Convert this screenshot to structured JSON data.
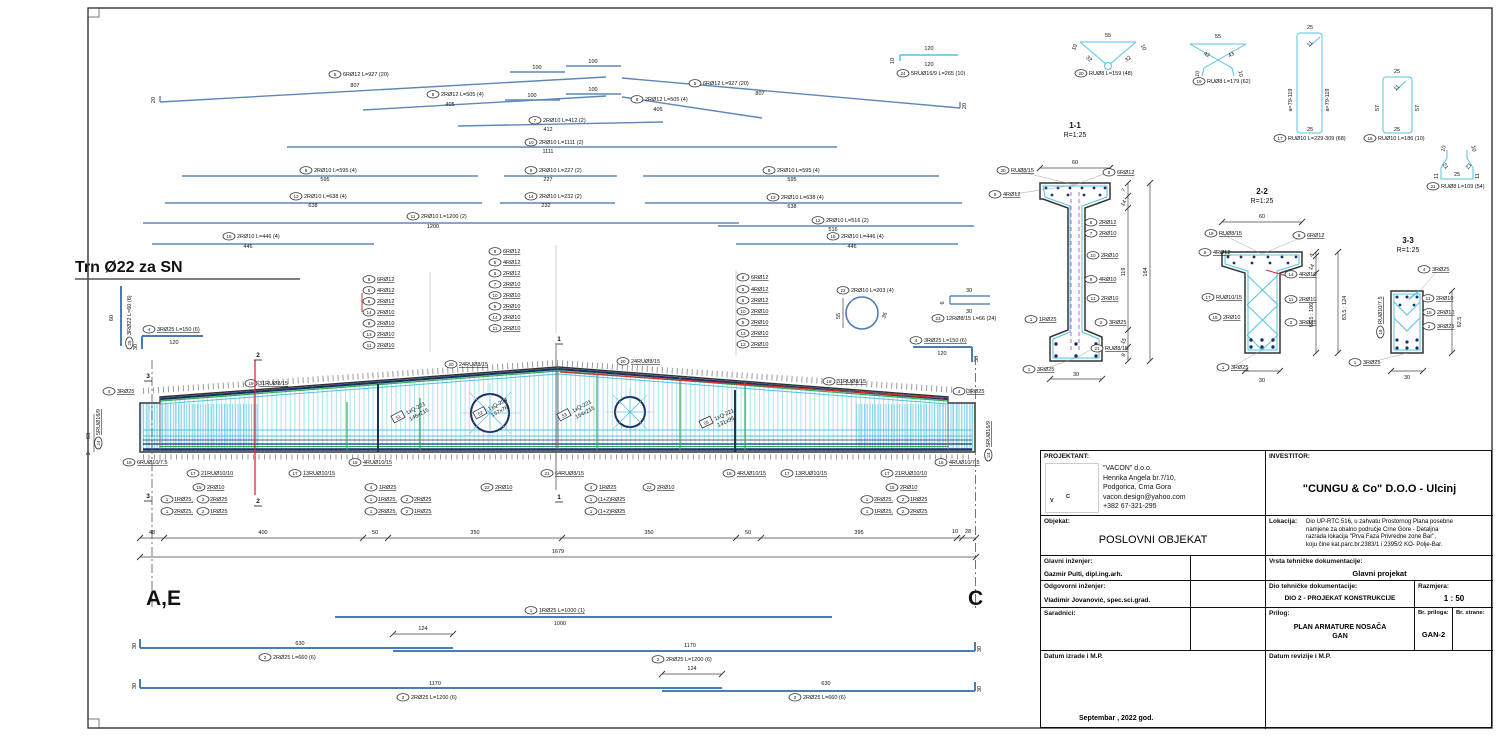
{
  "headings": {
    "trn": "Trn Ø22 za SN",
    "grid_left": "A,E",
    "grid_right": "C"
  },
  "bars": [
    {
      "mark": "5",
      "text": "6RØ12 L=927 (20)",
      "len": "807"
    },
    {
      "mark": "5",
      "text": "6RØ12 L=927 (20)",
      "len": "807"
    },
    {
      "mark": "8",
      "text": "2RØ12 L=505 (4)",
      "len": "405"
    },
    {
      "mark": "8",
      "text": "2RØ12 L=505 (4)",
      "len": "405"
    },
    {
      "mark": "7",
      "text": "2RØ10 L=412 (2)",
      "len": "412"
    },
    {
      "mark": "10",
      "text": "2RØ10 L=1111 (2)",
      "len": "1111"
    },
    {
      "mark": "9",
      "text": "2RØ10 L=595 (4)",
      "len": "595"
    },
    {
      "mark": "9",
      "text": "2RØ10 L=227 (2)",
      "len": "227"
    },
    {
      "mark": "9",
      "text": "2RØ10 L=595 (4)",
      "len": "595"
    },
    {
      "mark": "13",
      "text": "2RØ10 L=638 (4)",
      "len": "638"
    },
    {
      "mark": "14",
      "text": "2RØ10 L=232 (2)",
      "len": "232"
    },
    {
      "mark": "13",
      "text": "2RØ10 L=638 (4)",
      "len": "638"
    },
    {
      "mark": "11",
      "text": "2RØ10 L=1200 (2)",
      "len": "1200"
    },
    {
      "mark": "12",
      "text": "2RØ10 L=516 (2)",
      "len": "516"
    },
    {
      "mark": "15",
      "text": "2RØ10 L=446 (4)",
      "len": "446"
    },
    {
      "mark": "15",
      "text": "2RØ10 L=446 (4)",
      "len": "446"
    }
  ],
  "bar_dims": {
    "hook": "20",
    "d100": "100"
  },
  "details": {
    "d24": {
      "mark": "24",
      "text": "5RUØ16/9 L=265 (10)",
      "dim1": "120",
      "dim2": "120",
      "dim3": "10"
    },
    "d20": {
      "mark": "20",
      "text": "RUØ8 L=159 (48)",
      "w": "55",
      "s1": "10",
      "s2": "10",
      "b1": "32",
      "b2": "32"
    },
    "d19": {
      "mark": "19",
      "text": "RUØ8 L=179 (62)",
      "w": "55",
      "a1": "42",
      "a2": "43",
      "l1": "10",
      "l2": "10"
    },
    "d17": {
      "mark": "17",
      "text": "RUØ10 L=229-309 (68)",
      "top": "25",
      "diag": "11",
      "side": "a=79-119",
      "bottom": "25"
    },
    "d16": {
      "mark": "16",
      "text": "RUØ10 L=186 (10)",
      "top": "25",
      "diag": "11",
      "side": "57",
      "bottom": "25"
    },
    "d21": {
      "mark": "21",
      "text": "RUØ8 L=109 (54)",
      "t1": "10",
      "t2": "10",
      "m1": "21",
      "m2": "21",
      "s1": "11",
      "s2": "11",
      "b": "25"
    },
    "d22": {
      "mark": "22",
      "text": "2RØ10 L=203 (4)",
      "d1": "55",
      "d2": "36"
    },
    "d23": {
      "mark": "23",
      "text": "12RØ8/15 L=66 (24)",
      "d1": "30",
      "d2": "30",
      "d3": "6"
    },
    "d4l": {
      "mark": "4",
      "text": "3RØ25 L=150 (6)",
      "len": "120",
      "hook": "30"
    },
    "d4r": {
      "mark": "4",
      "text": "3RØ25 L=150 (6)",
      "len": "120",
      "hook": "30"
    },
    "d25": {
      "mark": "25",
      "text": "3RØ22 L=60 (6)",
      "len": "60"
    }
  },
  "s11": {
    "title": "1-1",
    "scale": "R=1:25",
    "top": "60",
    "bottom": "30",
    "d7": "7",
    "d14": "14",
    "d119": "119",
    "d164": "164",
    "d15": "15",
    "d9": "9",
    "l20": {
      "mark": "20",
      "text": "RUØ8/15"
    },
    "l5": {
      "mark": "5",
      "text": "4RØ12"
    },
    "l8": {
      "mark": "8",
      "text": "6RØ12"
    },
    "l6": {
      "mark": "6",
      "text": "2RØ12"
    },
    "l7": {
      "mark": "7",
      "text": "2RØ10"
    },
    "l10": {
      "mark": "10",
      "text": "2RØ10"
    },
    "l9": {
      "mark": "9",
      "text": "4RØ10"
    },
    "l11": {
      "mark": "11",
      "text": "2RØ10"
    },
    "l1a": {
      "mark": "1",
      "text": "1RØ25"
    },
    "l2": {
      "mark": "2",
      "text": "3RØ25"
    },
    "l21": {
      "mark": "21",
      "text": "RUØ8/15"
    },
    "l1b": {
      "mark": "1",
      "text": "3RØ25"
    }
  },
  "s22": {
    "title": "2-2",
    "scale": "R=1:25",
    "top": "60",
    "bottom": "30",
    "d4": "4",
    "d14": "14",
    "dmid": "65.5 : 106",
    "douter": "83.5 : 124",
    "l19": {
      "mark": "19",
      "text": "RUØ8/15"
    },
    "l5": {
      "mark": "5",
      "text": "4RØ12"
    },
    "l8": {
      "mark": "8",
      "text": "6RØ12"
    },
    "l14": {
      "mark": "14",
      "text": "4RØ10"
    },
    "l17": {
      "mark": "17",
      "text": "RUØ10/15"
    },
    "l11": {
      "mark": "11",
      "text": "2RØ10"
    },
    "l15": {
      "mark": "15",
      "text": "2RØ10"
    },
    "l2": {
      "mark": "2",
      "text": "3RØ25"
    },
    "l1": {
      "mark": "1",
      "text": "3RØ25"
    }
  },
  "s33": {
    "title": "3-3",
    "scale": "R=1:25",
    "right": "62.5",
    "bottom": "30",
    "l4": {
      "mark": "4",
      "text": "3RØ25"
    },
    "l11": {
      "mark": "11",
      "text": "2RØ10"
    },
    "l15": {
      "mark": "15",
      "text": "2RØ10"
    },
    "l2": {
      "mark": "2",
      "text": "3RØ25"
    },
    "l16": {
      "mark": "16",
      "text": "RUØ10/7.5"
    },
    "l1": {
      "mark": "1",
      "text": "3RØ25"
    }
  },
  "elev": {
    "stackA": [
      {
        "mark": "8",
        "text": "6RØ12"
      },
      {
        "mark": "5",
        "text": "4RØ12"
      },
      {
        "mark": "6",
        "text": "2RØ12"
      },
      {
        "mark": "14",
        "text": "2RØ10"
      },
      {
        "mark": "9",
        "text": "2RØ10"
      },
      {
        "mark": "13",
        "text": "2RØ10"
      },
      {
        "mark": "11",
        "text": "2RØ10"
      }
    ],
    "stackB": [
      {
        "mark": "8",
        "text": "6RØ12"
      },
      {
        "mark": "5",
        "text": "4RØ12"
      },
      {
        "mark": "6",
        "text": "2RØ12"
      },
      {
        "mark": "7",
        "text": "2RØ10"
      },
      {
        "mark": "10",
        "text": "2RØ10"
      },
      {
        "mark": "9",
        "text": "2RØ10"
      },
      {
        "mark": "14",
        "text": "2RØ10"
      },
      {
        "mark": "11",
        "text": "2RØ10"
      }
    ],
    "stackC": [
      {
        "mark": "8",
        "text": "6RØ12"
      },
      {
        "mark": "5",
        "text": "4RØ12"
      },
      {
        "mark": "6",
        "text": "2RØ12"
      },
      {
        "mark": "10",
        "text": "2RØ10"
      },
      {
        "mark": "9",
        "text": "2RØ10"
      },
      {
        "mark": "13",
        "text": "2RØ10"
      },
      {
        "mark": "12",
        "text": "2RØ10"
      }
    ],
    "c19": {
      "mark": "19",
      "text": "31RUØ8/15"
    },
    "c20": {
      "mark": "20",
      "text": "24RUØ8/15"
    },
    "c4": {
      "mark": "4",
      "text": "3RØ25"
    },
    "c24": {
      "mark": "24",
      "text": "5RUØ16/9"
    },
    "c16l": {
      "mark": "16",
      "text": "6RUØ10/7.5"
    },
    "c16r": {
      "mark": "16",
      "text": "4RUØ10/7.5"
    },
    "c17a": {
      "mark": "17",
      "text": "21RUØ10/10"
    },
    "c17b": {
      "mark": "17",
      "text": "13RUØ10/15"
    },
    "c18": {
      "mark": "18",
      "text": "4RUØ10/15"
    },
    "c15": {
      "mark": "15",
      "text": "2RØ10"
    },
    "c21": {
      "mark": "21",
      "text": "64RUØ8/15"
    },
    "c22": {
      "mark": "22",
      "text": "2RØ10"
    },
    "c41": {
      "mark": "4",
      "text": "1RØ25"
    },
    "p12a": {
      "m1": "1",
      "t1": "1RØ25,",
      "m2": "2",
      "t2": "2RØ25"
    },
    "p12b": {
      "m1": "1",
      "t1": "2RØ25,",
      "m2": "2",
      "t2": "1RØ25"
    },
    "p12c": {
      "m1": "1",
      "t1": "(1+2)RØ25"
    },
    "cut1": "1",
    "cut2": "2",
    "cut3": "3",
    "dim63": "63",
    "dim3": "3",
    "mesh": [
      {
        "mark": "51",
        "l1": "1xQ-221",
        "l2": "146x215"
      },
      {
        "mark": "52",
        "l1": "1xQ-224",
        "l2": "157x76"
      },
      {
        "mark": "53",
        "l1": "1xQ-221",
        "l2": "154x215"
      },
      {
        "mark": "55",
        "l1": "1xQ-221",
        "l2": "131x95"
      }
    ]
  },
  "dims": {
    "segs": [
      "48",
      "400",
      "50",
      "350",
      "350",
      "50",
      "395",
      "10",
      "28"
    ],
    "total": "1679"
  },
  "bb": {
    "b1": {
      "mark": "1",
      "text": "1RØ25 L=1000 (1)",
      "len": "1000"
    },
    "r2l": {
      "mark": "2",
      "text": "2RØ25 L=660 (6)",
      "len": "630"
    },
    "r2r": {
      "mark": "2",
      "text": "2RØ25 L=1200 (6)",
      "len": "1170"
    },
    "r3l": {
      "mark": "2",
      "text": "2RØ25 L=1200 (6)",
      "len": "1170"
    },
    "r3r": {
      "mark": "2",
      "text": "2RØ25 L=660 (6)",
      "len": "630"
    },
    "lap": "124",
    "hook": "30"
  },
  "tb": {
    "projektant_label": "PROJEKTANT:",
    "investitor_label": "INVESTITOR:",
    "logo": {
      "v": "V",
      "c": "C"
    },
    "vacon": [
      "\"VACON\" d.o.o.",
      "Henrika Angela br.7/10,",
      "Podgorica, Crna Gora",
      "vacon.design@yahoo.com",
      "+382 67-321-295"
    ],
    "investitor_name": "\"CUNGU & Co\" D.O.O - Ulcinj",
    "objekat_label": "Objekat:",
    "objekat_value": "POSLOVNI OBJEKAT",
    "lokacija_label": "Lokacija:",
    "lokacija_lines": [
      "Dio UP-RTC 516, u zahvatu Prostornog Plana posebne",
      "namjene za obalno područje Crne Gore - Detaljna",
      "razrada lokacija \"Prva Faza Privredne zone Bar\",",
      "koju čine kat.parc.br.2383/1 i 2395/2 KO- Polje-Bar."
    ],
    "glavni_label": "Glavni inženjer:",
    "glavni_value": "Gazmir Pulti, dipl.ing.arh.",
    "vrsta_label": "Vrsta tehničke dokumentacije:",
    "vrsta_value": "Glavni projekat",
    "odgovorni_label": "Odgovorni inženjer:",
    "odgovorni_value": "Vladimir Jovanović, spec.sci.grad.",
    "dio_label": "Dio tehničke dokumentacije:",
    "dio_value": "DIO 2 - PROJEKAT KONSTRUKCIJE",
    "razmjera_label": "Razmjera:",
    "razmjera_value": "1 : 50",
    "saradnici_label": "Saradnici:",
    "prilog_label": "Prilog:",
    "prilog_value1": "PLAN ARMATURE NOSAČA",
    "prilog_value2": "GAN",
    "br_priloga_label": "Br. priloga:",
    "br_priloga_value": "GAN-2",
    "br_strane_label": "Br. strane:",
    "datum_izrade_label": "Datum izrade i M.P.",
    "datum_value": "Septembar , 2022 god.",
    "datum_revizije_label": "Datum revizije i M.P."
  }
}
